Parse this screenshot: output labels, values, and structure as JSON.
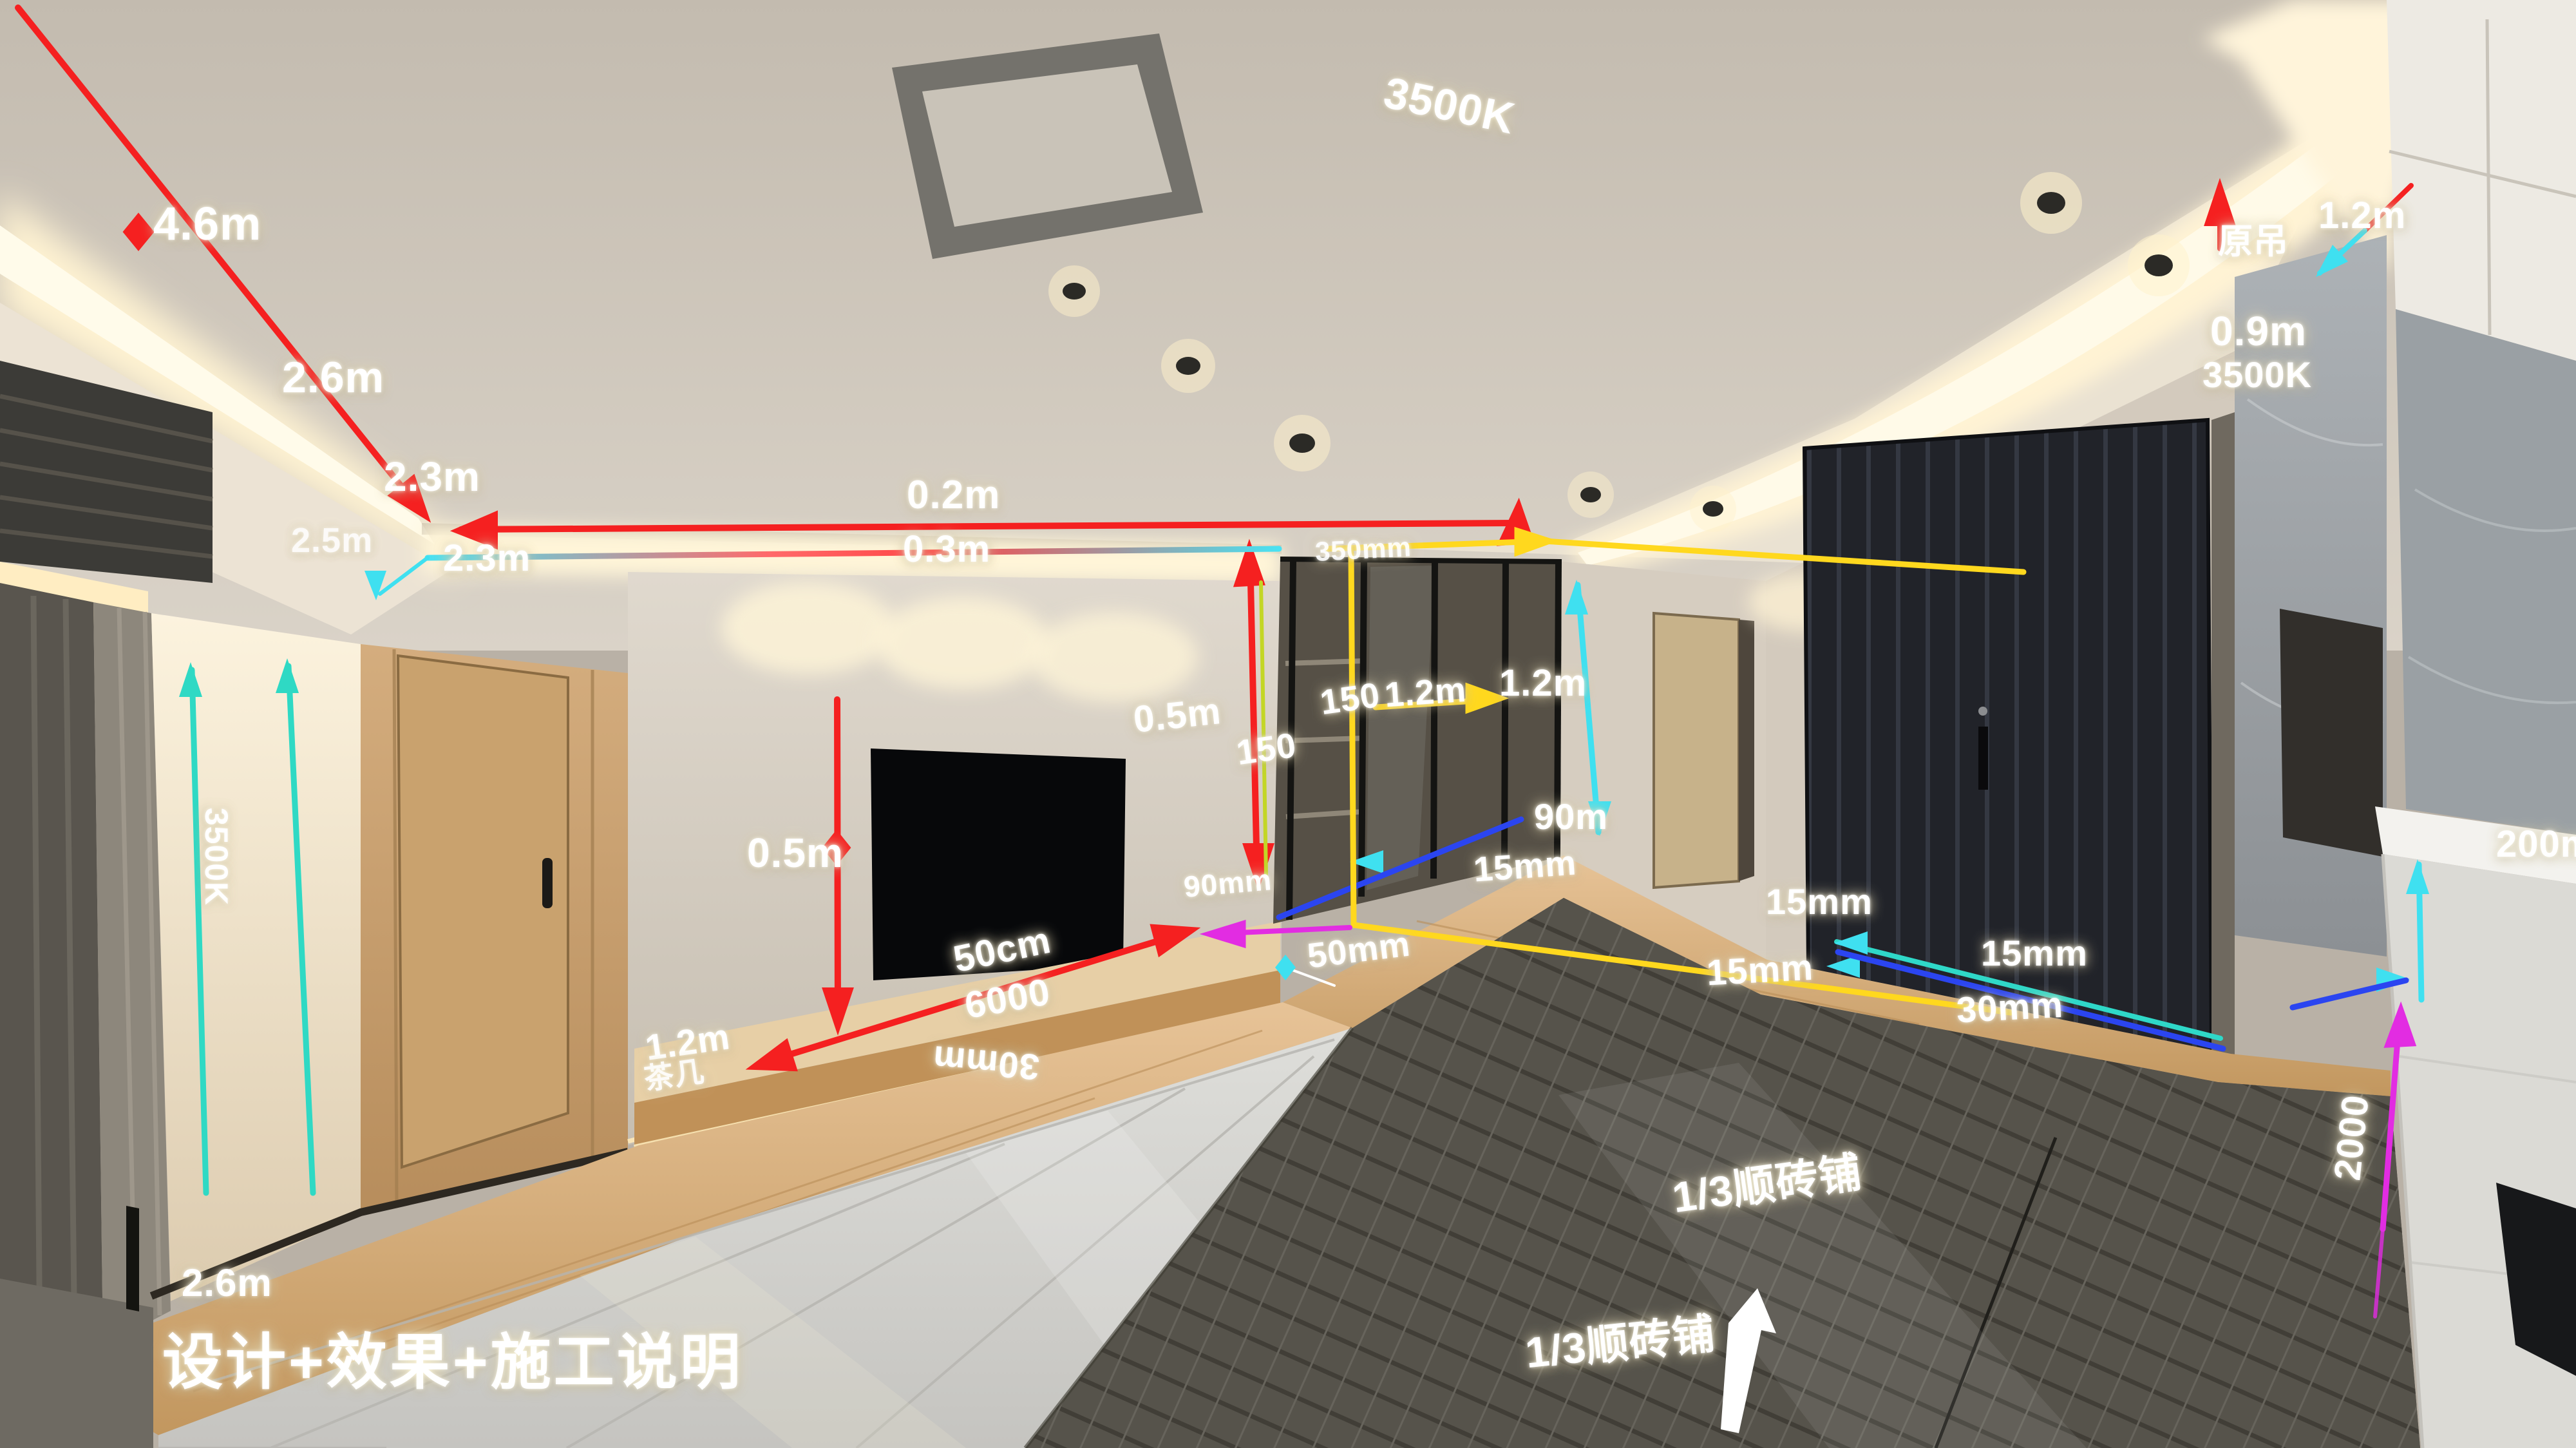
{
  "labels": [
    {
      "id": "len-4-6m-ceiling",
      "text": "4.6m"
    },
    {
      "id": "len-2-6m-ceiling",
      "text": "2.6m"
    },
    {
      "id": "len-2-3m-ceiling",
      "text": "2.3m"
    },
    {
      "id": "len-2-5m-cove",
      "text": "2.5m"
    },
    {
      "id": "cct-3500k-ceiling",
      "text": "3500K"
    },
    {
      "id": "gap-0-2m-soffit",
      "text": "0.2m"
    },
    {
      "id": "gap-0-3m-soffit",
      "text": "0.3m"
    },
    {
      "id": "len-2-3m-cove-line",
      "text": "2.3m"
    },
    {
      "id": "len-350mm-bulkhead",
      "text": "350mm"
    },
    {
      "id": "note-original-ceiling",
      "text": "原吊"
    },
    {
      "id": "len-1-2m-right",
      "text": "1.2m"
    },
    {
      "id": "len-0-9m-right",
      "text": "0.9m"
    },
    {
      "id": "cct-3500k-right",
      "text": "3500K"
    },
    {
      "id": "len-0-5m-glass",
      "text": "0.5m"
    },
    {
      "id": "len-150-upper",
      "text": "150"
    },
    {
      "id": "len-1-2m-yellow",
      "text": "1.2m"
    },
    {
      "id": "len-1-2m-cyan",
      "text": "1.2m"
    },
    {
      "id": "len-150-lower",
      "text": "150"
    },
    {
      "id": "len-90m-hall",
      "text": "90m"
    },
    {
      "id": "gap-15mm-hall",
      "text": "15mm"
    },
    {
      "id": "gap-90mm-floor",
      "text": "90mm"
    },
    {
      "id": "gap-50mm-floor",
      "text": "50mm"
    },
    {
      "id": "len-0-5m-tv",
      "text": "0.5m"
    },
    {
      "id": "len-50cm-cabinet",
      "text": "50cm"
    },
    {
      "id": "len-6000-cabinet",
      "text": "6000"
    },
    {
      "id": "gap-30mm-tile",
      "text": "30mm"
    },
    {
      "id": "len-1-2m-cabinet",
      "text": "1.2m"
    },
    {
      "id": "note-coffee-table",
      "text": "茶几"
    },
    {
      "id": "gap-15mm-door-a",
      "text": "15mm"
    },
    {
      "id": "gap-15mm-door-b",
      "text": "15mm"
    },
    {
      "id": "gap-15mm-door-c",
      "text": "15mm"
    },
    {
      "id": "gap-30mm-door",
      "text": "30mm"
    },
    {
      "id": "len-200mm-counter",
      "text": "200mm"
    },
    {
      "id": "len-2000-counter",
      "text": "2000"
    },
    {
      "id": "note-tile-layout-top",
      "text": "1/3顺砖铺"
    },
    {
      "id": "note-tile-layout-bot",
      "text": "1/3顺砖铺"
    },
    {
      "id": "len-2-6m-floor",
      "text": "2.6m"
    },
    {
      "id": "watermark",
      "text": "设计+效果+施工说明"
    },
    {
      "id": "cct-3500k-left",
      "text": "3500K"
    }
  ],
  "accent_colors": {
    "red": "#f52020",
    "yellow": "#ffd81e",
    "cyan": "#3fe0f0",
    "teal": "#2fd9c4",
    "blue": "#2b45f0",
    "magenta": "#e22ce2",
    "white": "#ffffff"
  }
}
